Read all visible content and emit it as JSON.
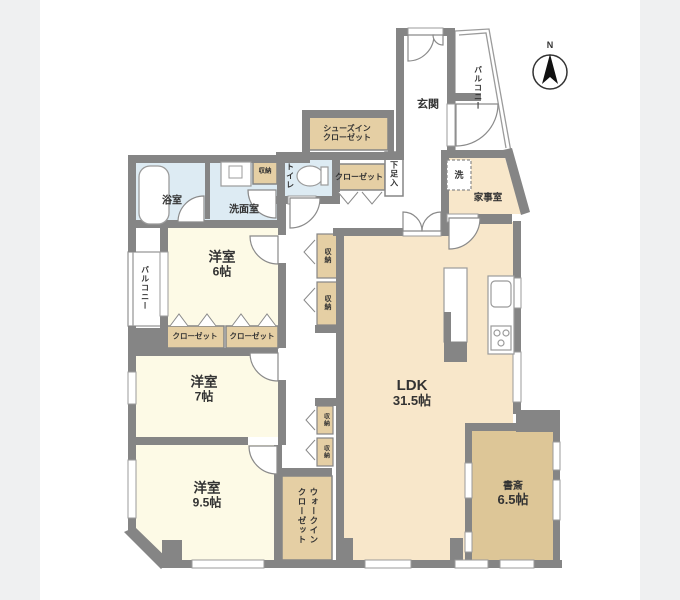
{
  "title": "間取り図",
  "compass": {
    "north_label": "N"
  },
  "colors": {
    "wall": "#858585",
    "bedroom_cream": "#fdfae6",
    "living_beige": "#f8e7ca",
    "closet_tan": "#e5cfa4",
    "study_tan": "#ddc697",
    "water_blue": "#ddebf3",
    "background_band": "#eff0f1",
    "outline": "#9b9b9b"
  },
  "rooms": {
    "bath": {
      "label": "浴室"
    },
    "washroom": {
      "label": "洗面室"
    },
    "storage_wash": {
      "label": "収納"
    },
    "toilet": {
      "label": "トイレ"
    },
    "shoes_in_closet": {
      "label": "シューズイン\nクローゼット"
    },
    "closet_hall": {
      "label": "クローゼット"
    },
    "shoe_cabinet": {
      "label": "下足入"
    },
    "entrance": {
      "label": "玄関"
    },
    "balcony_right": {
      "label": "バルコニー"
    },
    "washer": {
      "label": "洗"
    },
    "utility": {
      "label": "家事室"
    },
    "bedroom6": {
      "label": "洋室",
      "size": "6帖"
    },
    "storage_hall_upper": {
      "label": "収納"
    },
    "storage_hall_lower": {
      "label": "収納"
    },
    "balcony_left": {
      "label": "バルコニー"
    },
    "closet_b6_left": {
      "label": "クローゼット"
    },
    "closet_b6_right": {
      "label": "クローゼット"
    },
    "bedroom7": {
      "label": "洋室",
      "size": "7帖"
    },
    "bedroom95": {
      "label": "洋室",
      "size": "9.5帖"
    },
    "storage_low_upper": {
      "label": "収納"
    },
    "storage_low_lower": {
      "label": "収納"
    },
    "walk_in_closet": {
      "label": "ウォークイン\nクローゼット"
    },
    "ldk": {
      "label": "LDK",
      "size": "31.5帖"
    },
    "study": {
      "label": "書斎",
      "size": "6.5帖"
    }
  }
}
